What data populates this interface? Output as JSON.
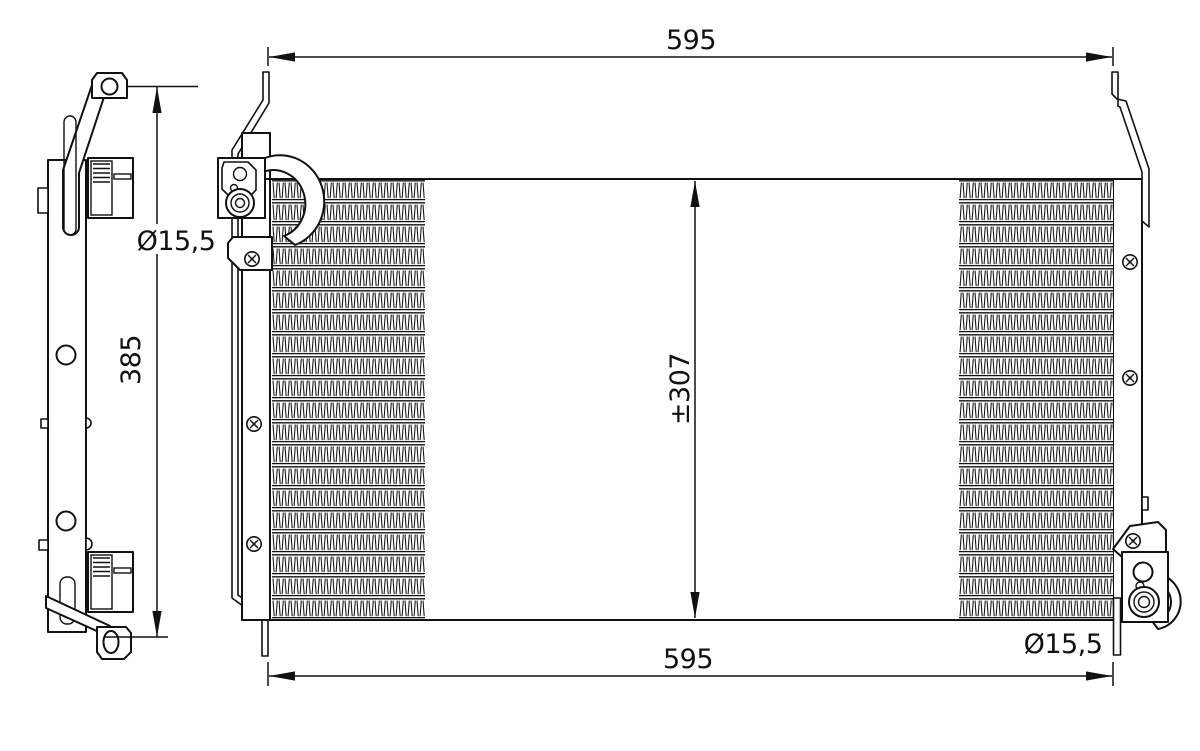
{
  "drawing": {
    "colors": {
      "ink": "#111111",
      "bg": "#ffffff"
    },
    "dimensions": {
      "top_width": {
        "label": "595"
      },
      "bottom_width": {
        "label": "595"
      },
      "core_height": {
        "label": "±307"
      },
      "side_height": {
        "label": "385"
      },
      "left_hole_diameter": {
        "label": "Ø15,5"
      },
      "right_hole_diameter": {
        "label": "Ø15,5"
      }
    }
  }
}
